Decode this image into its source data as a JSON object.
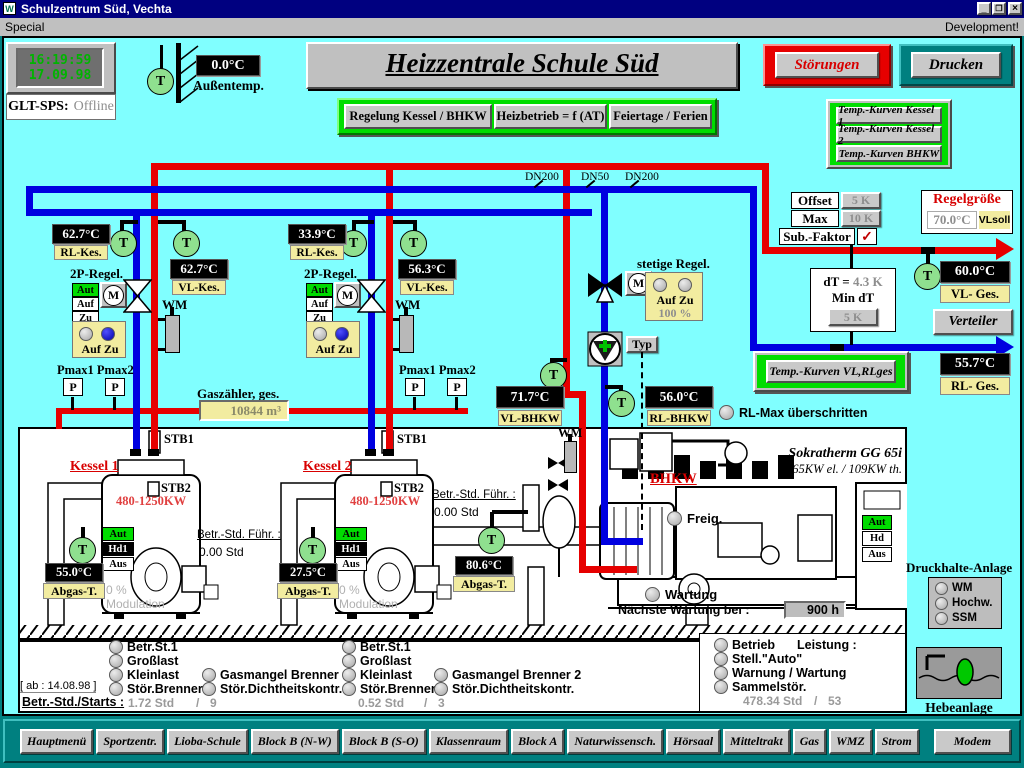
{
  "window": {
    "title": "Schulzentrum Süd, Vechta",
    "menu": "Special",
    "dev": "Development!",
    "min": "_",
    "max": "❐",
    "close": "×"
  },
  "clock": {
    "time": "16:19:59",
    "date": "17.09.98",
    "label": "GLT-SPS:",
    "status": "Offline"
  },
  "outside": {
    "value": "0.0°C",
    "label": "Außentemp."
  },
  "header": {
    "title": "Heizzentrale Schule Süd",
    "stoerungen": "Störungen",
    "drucken": "Drucken"
  },
  "topbar": {
    "b1": "Regelung Kessel / BHKW",
    "b2": "Heizbetrieb = f (AT)",
    "b3": "Feiertage / Ferien"
  },
  "curves": {
    "k1": "Temp.-Kurven Kessel 1",
    "k2": "Temp.-Kurven Kessel 2",
    "bhkw": "Temp.-Kurven BHKW",
    "vlrl": "Temp.-Kurven VL,RLges"
  },
  "params": {
    "offset_label": "Offset",
    "offset_value": "5 K",
    "max_label": "Max",
    "max_value": "10 K",
    "sub_label": "Sub.-Faktor",
    "check": "✓"
  },
  "regel": {
    "title": "Regelgröße",
    "value": "70.0°C",
    "badge": "VLsoll"
  },
  "dt": {
    "label": "dT =",
    "value": "4.3 K",
    "min_label": "Min dT",
    "button": "5 K"
  },
  "verteiler": "Verteiler",
  "dn": {
    "d1": "DN200",
    "d2": "DN50",
    "d3": "DN200"
  },
  "sym": {
    "t": "T",
    "m": "M",
    "p": "P"
  },
  "temps": {
    "k1_rl_v": "62.7°C",
    "k1_rl_l": "RL-Kes.",
    "k1_vl_v": "62.7°C",
    "k1_vl_l": "VL-Kes.",
    "k2_rl_v": "33.9°C",
    "k2_rl_l": "RL-Kes.",
    "k2_vl_v": "56.3°C",
    "k2_vl_l": "VL-Kes.",
    "vl_ges_v": "60.0°C",
    "vl_ges_l": "VL- Ges.",
    "rl_ges_v": "55.7°C",
    "rl_ges_l": "RL- Ges.",
    "vl_bhkw_v": "71.7°C",
    "vl_bhkw_l": "VL-BHKW",
    "rl_bhkw_v": "56.0°C",
    "rl_bhkw_l": "RL-BHKW",
    "k1_ab_v": "55.0°C",
    "k1_ab_l": "Abgas-T.",
    "k2_ab_v": "27.5°C",
    "k2_ab_l": "Abgas-T.",
    "ges_ab_v": "80.6°C",
    "ges_ab_l": "Abgas-T."
  },
  "rlmax": "RL-Max überschritten",
  "p2": {
    "title": "2P-Regel.",
    "aut": "Aut",
    "auf": "Auf",
    "zu": "Zu",
    "wm": "WM",
    "ind": "Auf Zu"
  },
  "stetige": {
    "title": "stetige Regel.",
    "ind": "Auf Zu",
    "pct": "100 %",
    "typ": "Typ"
  },
  "pmax": {
    "title": "Pmax1 Pmax2",
    "p": "P"
  },
  "gas": {
    "label": "Gaszähler, ges.",
    "value": "10844 m³"
  },
  "k1": {
    "name": "Kessel 1",
    "stb1": "STB1",
    "stb2": "STB2",
    "power": "480-1250KW",
    "aut": "Aut",
    "hd": "Hd1",
    "aus": "Aus",
    "betr_l": "Betr.-Std. Führ. :",
    "betr_v": "0.00 Std",
    "mod1": "0 %",
    "mod2": "Modulation"
  },
  "k2": {
    "name": "Kessel 2",
    "stb1": "STB1",
    "stb2": "STB2",
    "power": "480-1250KW",
    "aut": "Aut",
    "hd": "Hd1",
    "aus": "Aus",
    "betr_l": "Betr.-Std. Führ. :",
    "betr_v": "0.00 Std",
    "mod1": "0 %",
    "mod2": "Modulation"
  },
  "bhkw": {
    "name": "BHKW",
    "model": "Sokratherm GG 65i",
    "power": "65KW el. / 109KW th.",
    "freig": "Freig.",
    "aut": "Aut",
    "hd": "Hd",
    "aus": "Aus",
    "wartung": "Wartung",
    "next_l": "Nächste Wartung bei :",
    "next_v": "900 h",
    "wm": "WM"
  },
  "st1": {
    "a": "Betr.St.1",
    "b": "Großlast",
    "c": "Kleinlast",
    "d": "Stör.Brenner",
    "e": "Gasmangel Brenner 1",
    "f": "Stör.Dichtheitskontr.",
    "h": "1.72 Std",
    "sep": "/",
    "s": "9"
  },
  "st2": {
    "a": "Betr.St.1",
    "b": "Großlast",
    "c": "Kleinlast",
    "d": "Stör.Brenner",
    "e": "Gasmangel Brenner 2",
    "f": "Stör.Dichtheitskontr.",
    "h": "0.52 Std",
    "sep": "/",
    "s": "3"
  },
  "stb": {
    "a": "Betrieb",
    "le": "Leistung :",
    "b": "Stell.\"Auto\"",
    "c": "Warnung / Wartung",
    "d": "Sammelstör.",
    "h": "478.34 Std",
    "sep": "/",
    "s": "53"
  },
  "ab": "[ ab : 14.08.98 ]",
  "betr": "Betr.-Std./Starts :",
  "druck": {
    "title": "Druckhalte-Anlage",
    "a": "WM",
    "b": "Hochw.",
    "c": "SSM"
  },
  "hebe": "Hebeanlage",
  "nav": {
    "n0": "Hauptmenü",
    "n1": "Sportzentr.",
    "n2": "Lioba-Schule",
    "n3": "Block B (N-W)",
    "n4": "Block B (S-O)",
    "n5": "Klassenraum",
    "n6": "Block A",
    "n7": "Naturwissensch.",
    "n8": "Hörsaal",
    "n9": "Mitteltrakt",
    "n10": "Gas",
    "n11": "WMZ",
    "n12": "Strom",
    "n13": "Modem"
  },
  "colors": {
    "accent_red": "#E60000",
    "pipe_blue": "#0000E0",
    "cyan_bg": "#80FFFF",
    "teal": "#008080",
    "panel_green": "#00DD00",
    "badge_yellow": "#F2ECA0"
  }
}
